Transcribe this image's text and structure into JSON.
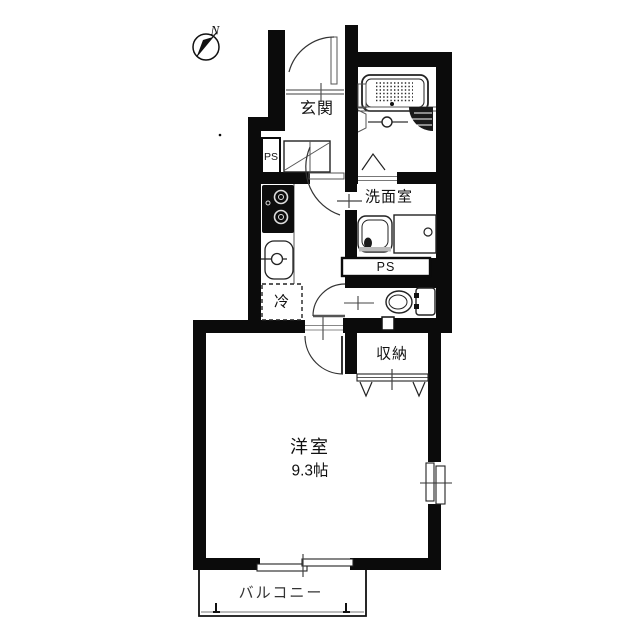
{
  "compass": {
    "north_label": "N"
  },
  "labels": {
    "entrance": "玄関",
    "washroom": "洗面室",
    "pipe_space_upper": "PS",
    "pipe_space_lower": "PS",
    "refrigerator": "冷",
    "storage": "収納",
    "main_room": "洋室",
    "main_room_size": "9.3帖",
    "balcony": "バルコニー"
  },
  "colors": {
    "wall": "#0b0b0b",
    "line": "#333333",
    "background": "#ffffff",
    "label": "#111111"
  }
}
